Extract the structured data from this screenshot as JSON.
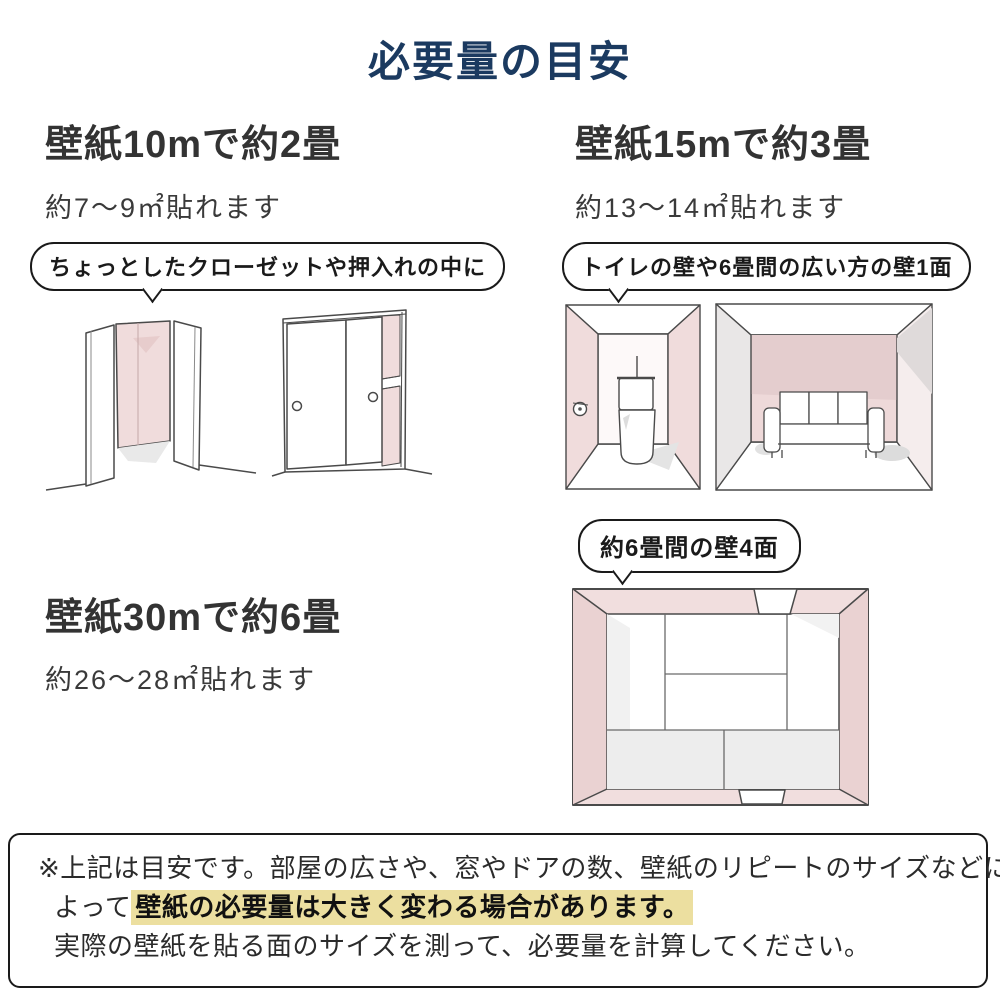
{
  "title": "必要量の目安",
  "colors": {
    "title_navy": "#1b3a60",
    "text_dark": "#333333",
    "wall_pink": "#f0dcdc",
    "wall_pink_dark": "#e7cccc",
    "shadow_gray": "#e9e9e9",
    "highlight_yellow": "#ecdfa0"
  },
  "sections": {
    "s10": {
      "heading": "壁紙10mで約2畳",
      "sub": "約7〜9㎡貼れます",
      "bubble": "ちょっとしたクローゼットや押入れの中に"
    },
    "s15": {
      "heading": "壁紙15mで約3畳",
      "sub": "約13〜14㎡貼れます",
      "bubble": "トイレの壁や6畳間の広い方の壁1面"
    },
    "s30": {
      "heading": "壁紙30mで約6畳",
      "sub": "約26〜28㎡貼れます",
      "bubble": "約6畳間の壁4面"
    }
  },
  "illustrations": [
    "closet-open-illustration",
    "closet-sliding-doors-illustration",
    "toilet-room-illustration",
    "sofa-room-illustration",
    "room-top-view-illustration"
  ],
  "note": {
    "line1": "※上記は目安です。部屋の広さや、窓やドアの数、壁紙のリピートのサイズなどに",
    "line2_prefix": "よって",
    "line2_highlight": "壁紙の必要量は大きく変わる場合があります。",
    "line3": "実際の壁紙を貼る面のサイズを測って、必要量を計算してください。"
  }
}
